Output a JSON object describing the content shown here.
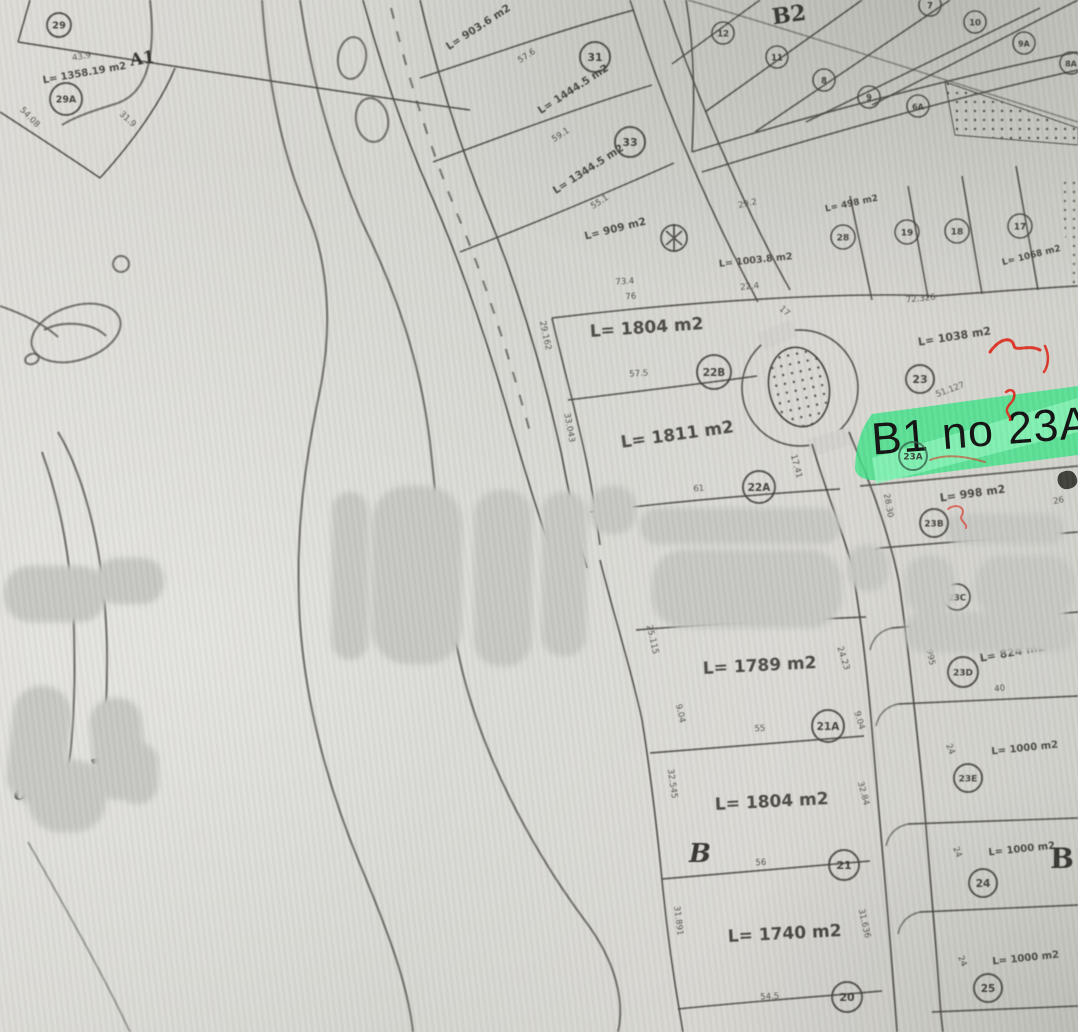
{
  "highlight": {
    "label": "B1 no 23A",
    "color": "#3fe287"
  },
  "zones": {
    "a1": "A1",
    "b2": "B2",
    "b_mid": "B",
    "b_right": "B"
  },
  "plots": [
    "29",
    "29A",
    "31",
    "33",
    "22B",
    "22A",
    "23",
    "23A",
    "23B",
    "23C",
    "23D",
    "23E",
    "24",
    "25",
    "21A",
    "21",
    "20",
    "12",
    "11",
    "8",
    "9",
    "6A",
    "7",
    "10",
    "9A",
    "8A",
    "28",
    "19",
    "18",
    "17"
  ],
  "areas": [
    "L= 1358.19 m2",
    "L= 903.6 m2",
    "L= 1444.5 m2",
    "L= 1344.5 m2",
    "L= 909 m2",
    "L= 1003.8 m2",
    "L= 498 m2",
    "L= 1068 m2",
    "L= 1804 m2",
    "L= 1811 m2",
    "L= 1038 m2",
    "L= 998 m2",
    "L= 824 m2",
    "L= 1000 m2",
    "L= 1789 m2",
    "L= 1804 m2",
    "L= 1740 m2",
    "L= 1000 m2",
    "L= 1000 m2"
  ],
  "dims": [
    "43.9",
    "54.08",
    "31.9",
    "57.6",
    "59.1",
    "55.1",
    "29.2",
    "73.4",
    "76",
    "22.4",
    "72.326",
    "57.5",
    "61",
    "17",
    "17.41",
    "51.127",
    "29.162",
    "33.043",
    "25.115",
    "24.23",
    "9.04",
    "9.04",
    "55",
    "32.545",
    "32.84",
    "56",
    "31.891",
    "31.636",
    "54.5",
    "28.30",
    "26.995",
    "40",
    "24",
    "24",
    "24",
    "26"
  ],
  "handwriting": {
    "text": "olin"
  }
}
